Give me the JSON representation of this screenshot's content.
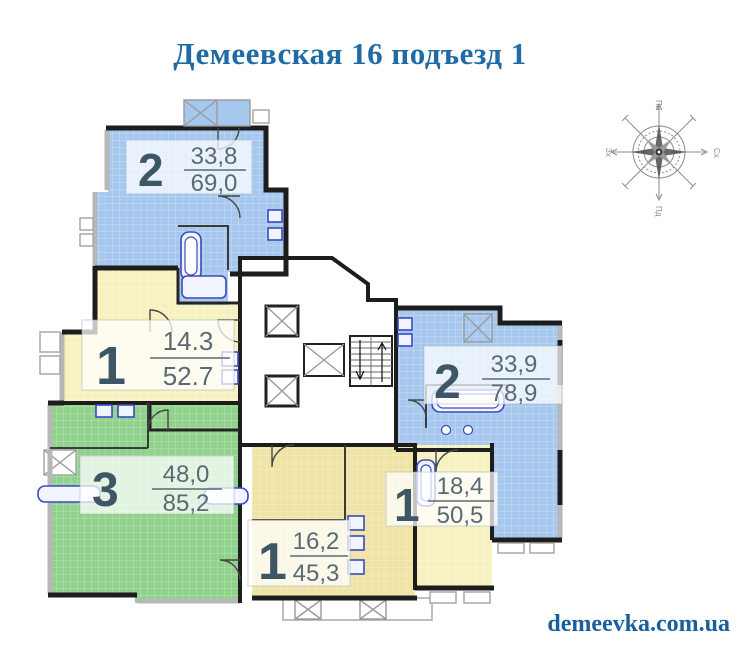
{
  "page": {
    "title": "Демеевская 16 подъезд 1",
    "title_color": "#1e6ba6",
    "watermark": "demeevka.com.ua",
    "watermark_color": "#1a5e9c",
    "background": "#ffffff",
    "wall_color": "#1d1d1d"
  },
  "compass": {
    "north": "Пн",
    "east": "Сх",
    "south": "Пд",
    "west": "Зх"
  },
  "apartments": [
    {
      "name": "top-left-2-room",
      "rooms": "2",
      "living_area": "33,8",
      "total_area": "69,0",
      "fill": "#a6c8ef"
    },
    {
      "name": "left-1-room",
      "rooms": "1",
      "living_area": "14.3",
      "total_area": "52.7",
      "fill": "#f7f1c0"
    },
    {
      "name": "bottom-left-3-room",
      "rooms": "3",
      "living_area": "48,0",
      "total_area": "85,2",
      "fill": "#90d18c"
    },
    {
      "name": "right-2-room",
      "rooms": "2",
      "living_area": "33,9",
      "total_area": "78,9",
      "fill": "#a6c8ef"
    },
    {
      "name": "bottom-right-1-room",
      "rooms": "1",
      "living_area": "18,4",
      "total_area": "50,5",
      "fill": "#f7f1c0"
    },
    {
      "name": "bottom-center-1-room",
      "rooms": "1",
      "living_area": "16,2",
      "total_area": "45,3",
      "fill": "#efe3a6"
    }
  ]
}
